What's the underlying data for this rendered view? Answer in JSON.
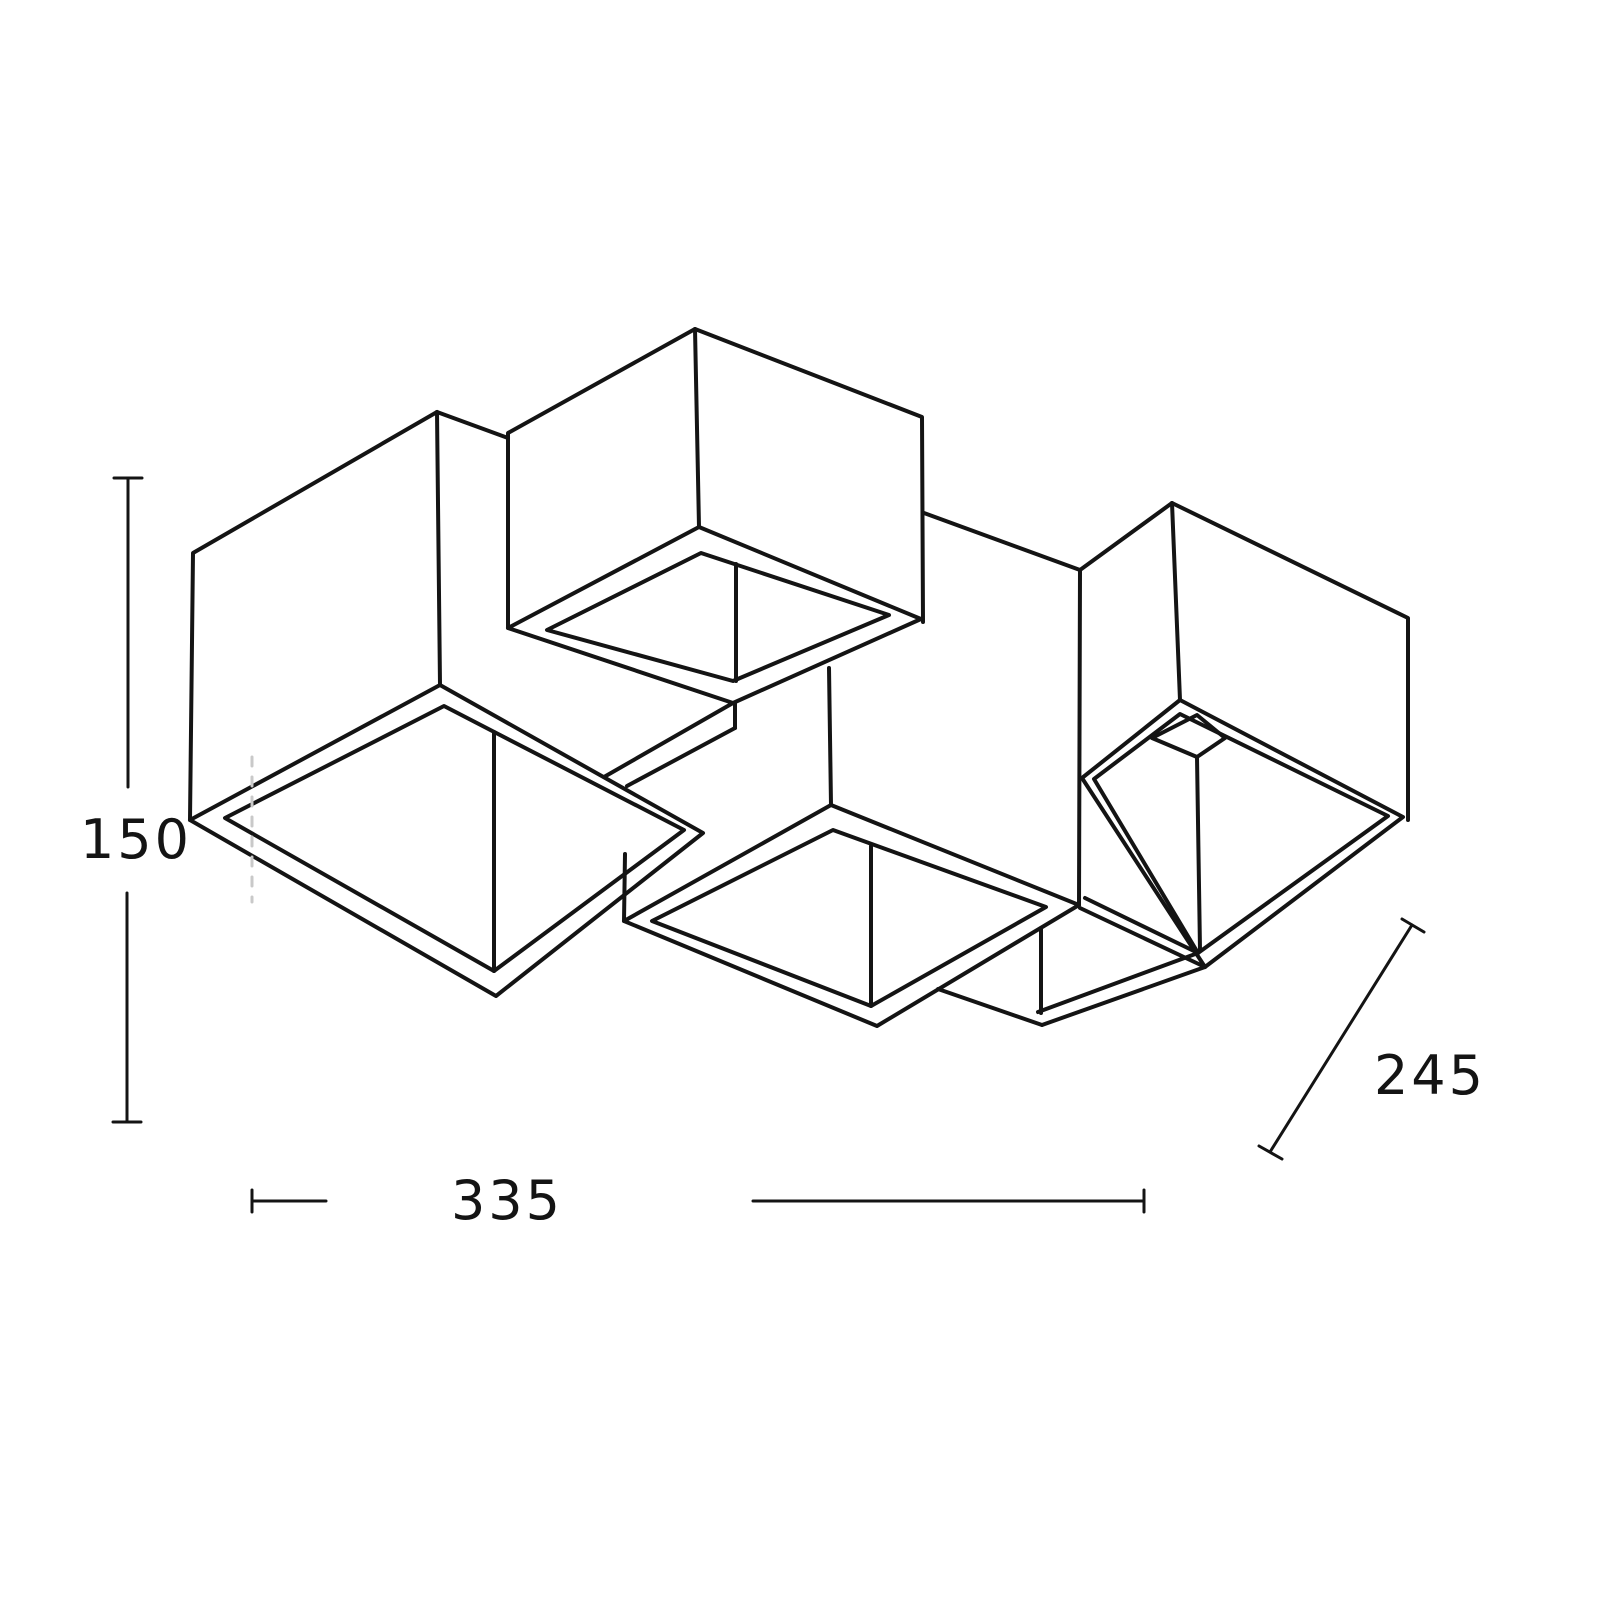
{
  "page": {
    "background_color": "#ffffff"
  },
  "drawing": {
    "type": "technical-dimension-line-drawing",
    "subject": "ceiling lamp with four cube-shaped shades, open bottoms, viewed from below in axonometric projection",
    "line_color": "#141414",
    "guide_line_color": "#c9c9c9",
    "dimensions": {
      "height": {
        "label": "150",
        "value": 150,
        "orientation": "vertical-left"
      },
      "width": {
        "label": "335",
        "value": 335,
        "orientation": "horizontal-bottom"
      },
      "depth": {
        "label": "245",
        "value": 245,
        "orientation": "diagonal-right"
      }
    }
  }
}
